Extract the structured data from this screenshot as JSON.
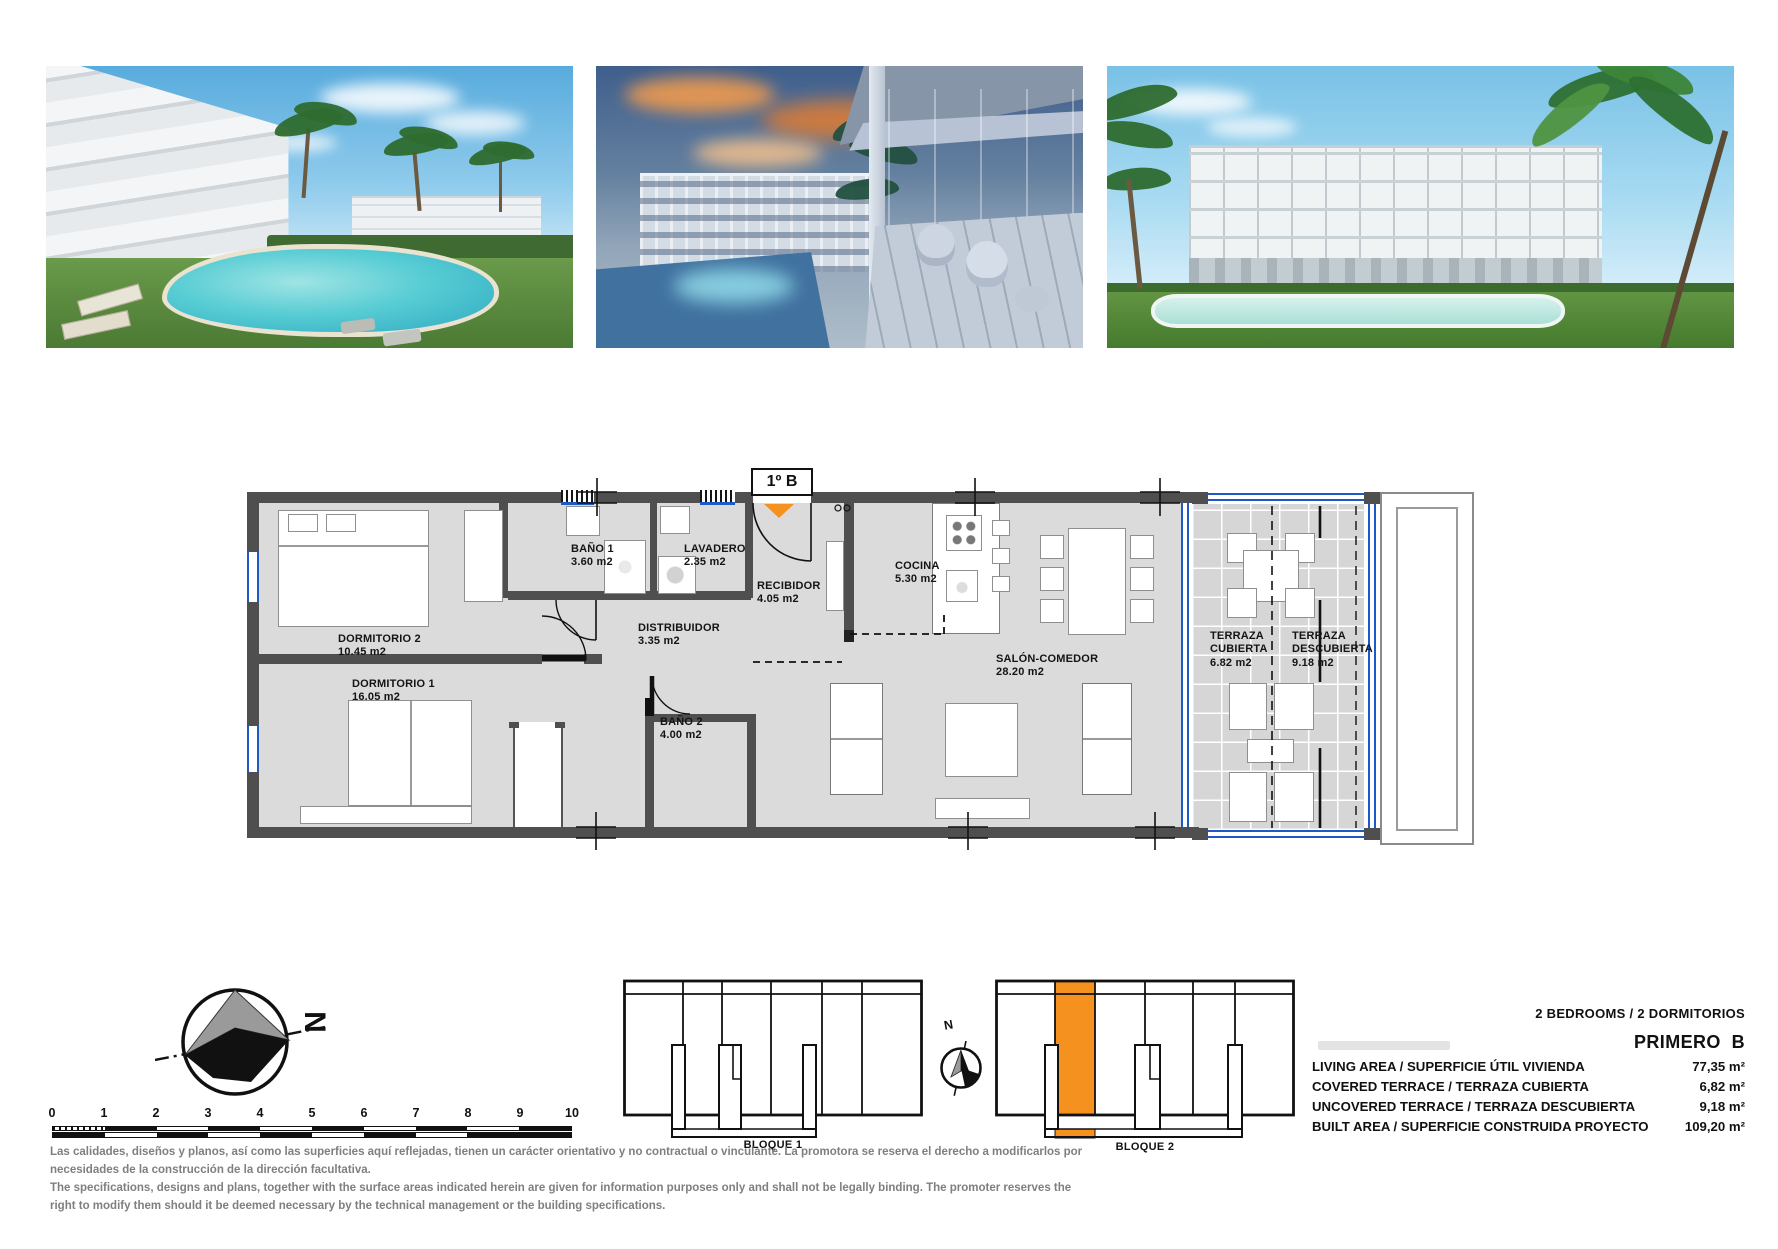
{
  "colors": {
    "accent_orange": "#F5911E",
    "glass_blue": "#1D5AC8",
    "wall_gray": "#4F4F4F",
    "floor_gray": "#DBDBDB",
    "disclaimer_gray": "#7F7F7F"
  },
  "floor_plan": {
    "unit_label": "1º B",
    "rooms": [
      {
        "name": "DORMITORIO 2",
        "area": "10.45 m2"
      },
      {
        "name": "DORMITORIO 1",
        "area": "16.05 m2"
      },
      {
        "name": "BAÑO 1",
        "area": "3.60 m2"
      },
      {
        "name": "LAVADERO",
        "area": "2.35 m2"
      },
      {
        "name": "RECIBIDOR",
        "area": "4.05 m2"
      },
      {
        "name": "DISTRIBUIDOR",
        "area": "3.35 m2"
      },
      {
        "name": "BAÑO 2",
        "area": "4.00 m2"
      },
      {
        "name": "COCINA",
        "area": "5.30 m2"
      },
      {
        "name": "SALÓN-COMEDOR",
        "area": "28.20 m2"
      },
      {
        "name": "TERRAZA CUBIERTA",
        "area": "6.82 m2"
      },
      {
        "name": "TERRAZA DESCUBIERTA",
        "area": "9.18 m2"
      }
    ]
  },
  "compass": {
    "letter": "N"
  },
  "site_compass": {
    "letter": "N"
  },
  "scale_bar": {
    "ticks": [
      "0",
      "1",
      "2",
      "3",
      "4",
      "5",
      "6",
      "7",
      "8",
      "9",
      "10"
    ]
  },
  "blocks": [
    {
      "label": "BLOQUE 1"
    },
    {
      "label": "BLOQUE 2"
    }
  ],
  "summary": {
    "type_line": "2 BEDROOMS / 2 DORMITORIOS",
    "unit_name": "PRIMERO  B",
    "rows": [
      {
        "label": "LIVING AREA / SUPERFICIE ÚTIL VIVIENDA",
        "value": "77,35 m²"
      },
      {
        "label": "COVERED TERRACE / TERRAZA CUBIERTA",
        "value": "6,82 m²"
      },
      {
        "label": "UNCOVERED TERRACE / TERRAZA DESCUBIERTA",
        "value": "9,18 m²"
      },
      {
        "label": "BUILT AREA / SUPERFICIE CONSTRUIDA PROYECTO",
        "value": "109,20 m²"
      }
    ]
  },
  "disclaimer": {
    "lines": [
      "Las calidades, diseños y planos, así como las superficies aquí reflejadas, tienen un carácter orientativo y no contractual o vinculante. La promotora se reserva el derecho a modificarlos por",
      "necesidades de la construcción de la dirección facultativa.",
      "The specifications, designs and plans, together with the surface areas indicated herein are given for information purposes only and shall not be legally binding. The promoter reserves the",
      "right to modify them should it be deemed necessary by the technical management or the building specifications."
    ]
  }
}
